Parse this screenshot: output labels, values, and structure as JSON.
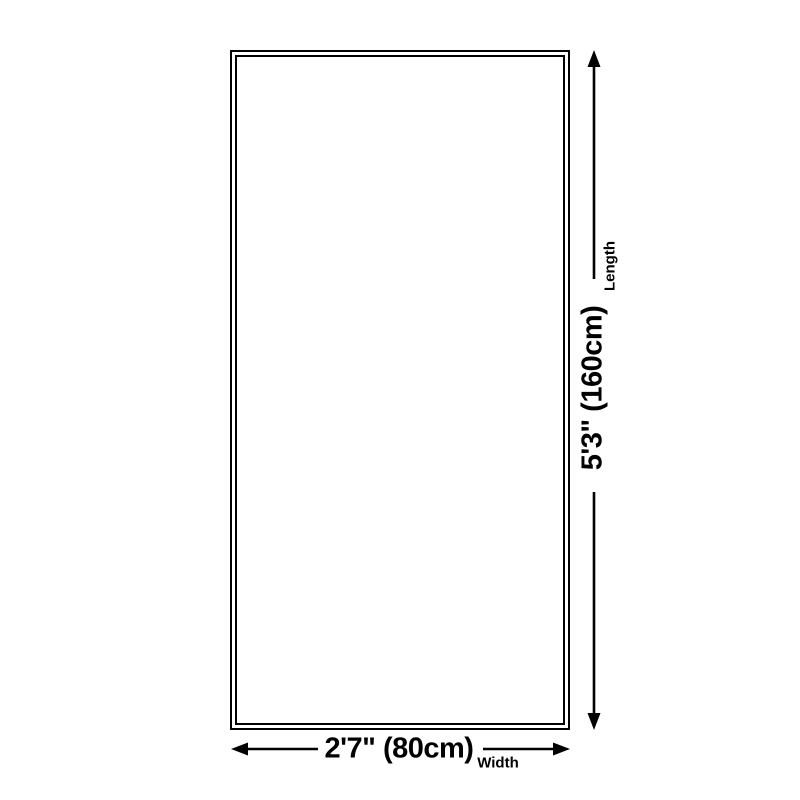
{
  "diagram": {
    "title": "product-dimension-diagram",
    "length": {
      "value": "5'3\" (160cm)",
      "label": "Length"
    },
    "width": {
      "value": "2'7\" (80cm)",
      "label": "Width"
    },
    "colors": {
      "line": "#000000",
      "background": "#ffffff"
    }
  }
}
